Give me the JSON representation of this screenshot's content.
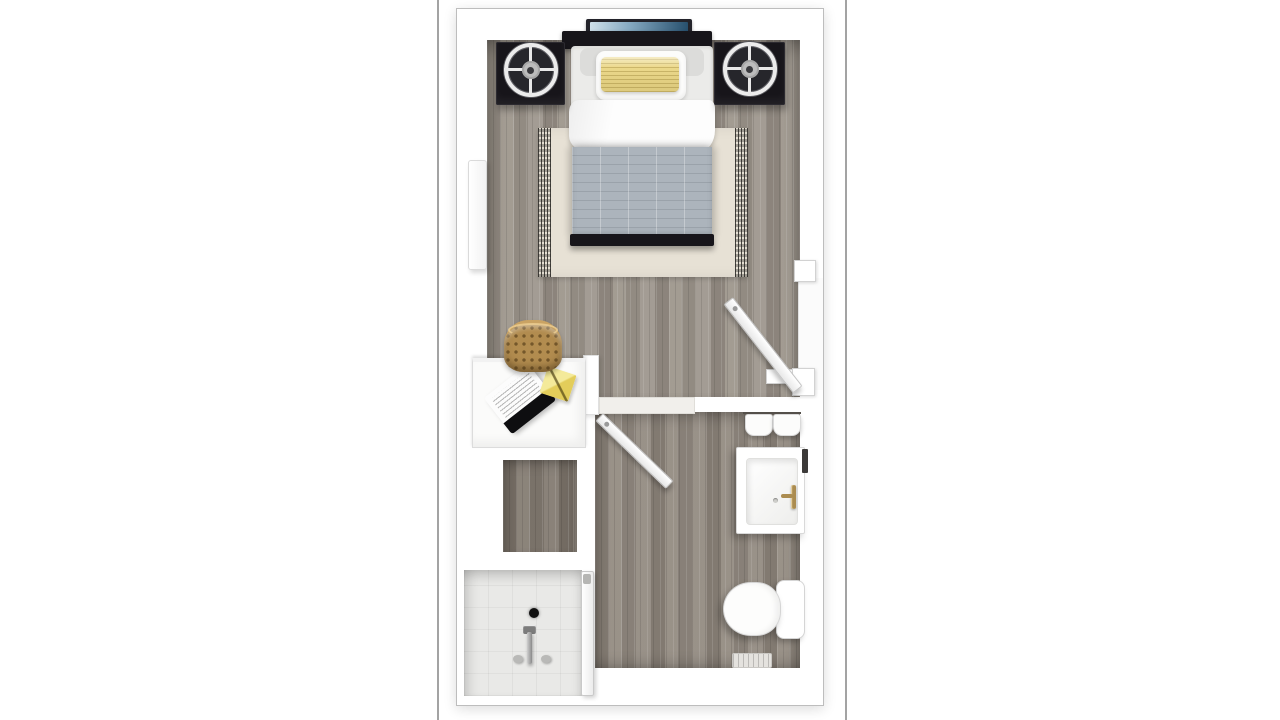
{
  "meta": {
    "kind": "floor-plan-rendering",
    "description": "3D top-down color floor plan of a studio apartment: bedroom with queen bed, two black nightstands with round fans, wall TV, area rug, wicker chair and built-in desk nook, a closet, a tiled walk-in shower, and a bathroom with vanity sink, towels and toilet.",
    "visible_text": ""
  },
  "colors": {
    "page-bg": "#ffffff",
    "plan-border": "#a3a3a3",
    "wall": "#ffffff",
    "wall-line": "#bdbdbd",
    "wood-bedroom": "#9b948b",
    "wood-bathroom": "#8f877e",
    "wood-closet": "#7d756c",
    "tile-shower": "#e9e9e7",
    "rug": "#e7e1d5",
    "duvet": "#acb4bc",
    "pillow-yellow": "#ecd98b",
    "furniture-dark": "#17151a",
    "basket": "#b28c4f",
    "tv-screen-start": "#cfe0ea",
    "tv-screen-end": "#27506e",
    "faucet-gold": "#ab8c50"
  },
  "rooms": [
    {
      "name": "bedroom",
      "floor": "gray wood planks",
      "features": [
        "bed",
        "tv",
        "nightstand-left",
        "nightstand-right",
        "rug",
        "wall-mirror",
        "basket-chair",
        "entry-door"
      ]
    },
    {
      "name": "desk-nook",
      "floor": "white",
      "features": [
        "desk",
        "laptop",
        "notepad"
      ]
    },
    {
      "name": "closet",
      "floor": "dark wood planks",
      "features": []
    },
    {
      "name": "shower",
      "floor": "white tile",
      "features": [
        "drain",
        "faucet",
        "glass-door"
      ]
    },
    {
      "name": "bathroom",
      "floor": "gray wood planks",
      "features": [
        "vanity-sink",
        "towels",
        "toilet",
        "floor-vent",
        "bathroom-door"
      ]
    }
  ],
  "furniture": [
    {
      "name": "bed",
      "parts": [
        "headboard",
        "back-pillow",
        "white-pillow",
        "yellow-striped-pillow",
        "white-blanket",
        "gray-grid-duvet",
        "black-bench"
      ]
    },
    {
      "name": "tv",
      "note": "wall-mounted above headboard, blue screen"
    },
    {
      "name": "nightstands",
      "count": 2,
      "note": "black cubes each topped with a round white-ring fan"
    },
    {
      "name": "rug",
      "note": "beige with dark side fringe, under bed"
    },
    {
      "name": "desk",
      "note": "white built-in with laptop and yellow notepad"
    },
    {
      "name": "basket-chair",
      "note": "tan wicker, at desk opening"
    },
    {
      "name": "vanity",
      "note": "white sink cabinet with gold faucet against right wall"
    },
    {
      "name": "toilet",
      "note": "bowl plus tank against right wall"
    },
    {
      "name": "shower-fixture",
      "note": "chrome mixer with two handles and black drain"
    },
    {
      "name": "doors",
      "count": 2,
      "note": "entry door swings into bedroom from right wall; bathroom door swings into bathroom"
    }
  ]
}
